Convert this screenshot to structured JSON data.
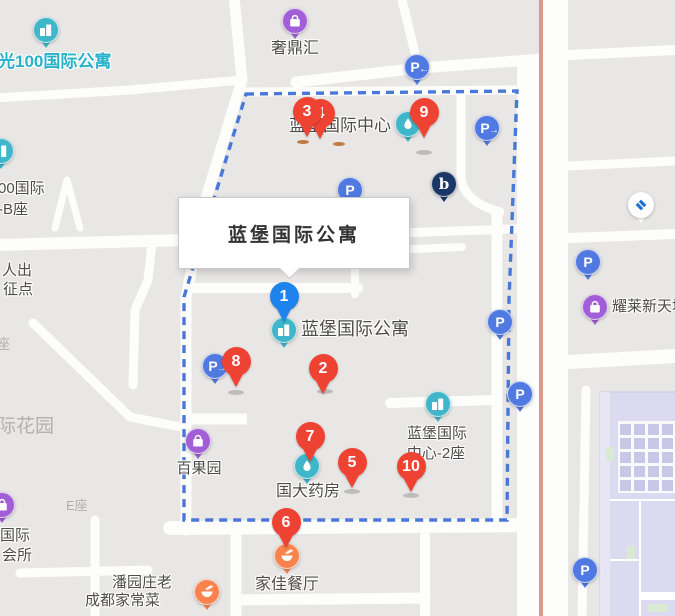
{
  "colors": {
    "map_background": "#e8e7e5",
    "road_white": "#fdfdfc",
    "boundary_dash_blue": "#4a78d9",
    "roadside_salmon": "#db998d",
    "pin_red": "#ee4333",
    "pin_blue": "#1f83ee",
    "poi_teal": "#3fb6c9",
    "poi_purple": "#a25ed6",
    "poi_orange": "#f9824d",
    "poi_parking_blue": "#5079e2",
    "poi_navy": "#1b3767",
    "bank_logo_blue": "#1c6fd0",
    "indoor_lavender": "#dbdaf0",
    "indoor_cell": "#c8c7e8",
    "indoor_green": "#d8ead2"
  },
  "map": {
    "infobox": {
      "text": "蓝堡国际公寓",
      "x": 178,
      "y": 197,
      "w": 230,
      "h": 70,
      "pointer_x": 288
    },
    "markers": [
      {
        "label": "4",
        "color": "red",
        "x": 320,
        "y": 114
      },
      {
        "label": "3",
        "color": "red",
        "x": 307,
        "y": 112
      },
      {
        "label": "9",
        "color": "red",
        "x": 424,
        "y": 113
      },
      {
        "label": "1",
        "color": "blue",
        "x": 284,
        "y": 297
      },
      {
        "label": "8",
        "color": "red",
        "x": 236,
        "y": 362
      },
      {
        "label": "2",
        "color": "red",
        "x": 323,
        "y": 369
      },
      {
        "label": "7",
        "color": "red",
        "x": 310,
        "y": 437
      },
      {
        "label": "5",
        "color": "red",
        "x": 352,
        "y": 463
      },
      {
        "label": "10",
        "color": "red",
        "x": 411,
        "y": 467
      },
      {
        "label": "6",
        "color": "red",
        "x": 286,
        "y": 523
      }
    ],
    "pois": [
      {
        "name": "apartment-building-icon",
        "glyph": "building",
        "color": "teal",
        "x": 46,
        "y": 30
      },
      {
        "name": "building-icon-left-edge",
        "glyph": "building",
        "color": "teal",
        "x": 1,
        "y": 151
      },
      {
        "name": "shopping-bag-icon",
        "glyph": "bag",
        "color": "purple",
        "x": 295,
        "y": 21
      },
      {
        "name": "parking-arrow-left-icon",
        "glyph": "P←",
        "color": "blue",
        "x": 417,
        "y": 67
      },
      {
        "name": "parking-arrow-right-icon",
        "glyph": "P→",
        "color": "blue",
        "x": 487,
        "y": 128
      },
      {
        "name": "droplet-icon",
        "glyph": "drop",
        "color": "teal",
        "x": 408,
        "y": 124
      },
      {
        "name": "brand-b-icon",
        "glyph": "b",
        "color": "navy",
        "x": 444,
        "y": 184
      },
      {
        "name": "parking-icon",
        "glyph": "P",
        "color": "blue",
        "x": 350,
        "y": 190
      },
      {
        "name": "bank-ccb-icon",
        "glyph": "ccb",
        "color": "white",
        "x": 641,
        "y": 205
      },
      {
        "name": "parking-icon",
        "glyph": "P",
        "color": "blue",
        "x": 588,
        "y": 262
      },
      {
        "name": "shopping-bag-icon",
        "glyph": "bag",
        "color": "purple",
        "x": 595,
        "y": 307
      },
      {
        "name": "apartment-building-icon",
        "glyph": "building",
        "color": "teal",
        "x": 284,
        "y": 330
      },
      {
        "name": "parking-arrow-right-icon",
        "glyph": "P→",
        "color": "blue",
        "x": 215,
        "y": 366
      },
      {
        "name": "parking-icon",
        "glyph": "P",
        "color": "blue",
        "x": 500,
        "y": 322
      },
      {
        "name": "parking-icon",
        "glyph": "P",
        "color": "blue",
        "x": 520,
        "y": 394
      },
      {
        "name": "office-building-icon",
        "glyph": "building",
        "color": "teal",
        "x": 438,
        "y": 404
      },
      {
        "name": "shopping-bag-icon",
        "glyph": "bag",
        "color": "purple",
        "x": 198,
        "y": 441
      },
      {
        "name": "pharmacy-droplet-icon",
        "glyph": "drop",
        "color": "teal",
        "x": 307,
        "y": 466
      },
      {
        "name": "shopping-bag-icon",
        "glyph": "bag",
        "color": "purple",
        "x": 2,
        "y": 505
      },
      {
        "name": "parking-icon",
        "glyph": "P",
        "color": "blue",
        "x": 585,
        "y": 570
      },
      {
        "name": "restaurant-bowl-icon",
        "glyph": "bowl",
        "color": "orange",
        "x": 287,
        "y": 556
      },
      {
        "name": "restaurant-bowl-icon",
        "glyph": "bowl",
        "color": "orange",
        "x": 207,
        "y": 592
      }
    ],
    "labels": [
      {
        "text": "光100国际公寓",
        "x": -2,
        "y": 63,
        "align": "left",
        "color": "teal",
        "size": 17,
        "inter": true
      },
      {
        "text": "奢鼎汇",
        "x": 295,
        "y": 50,
        "align": "center",
        "color": "dark",
        "size": 16,
        "inter": true
      },
      {
        "text": "蓝堡国际中心",
        "x": 340,
        "y": 127,
        "align": "center",
        "color": "dark",
        "size": 17,
        "inter": true
      },
      {
        "text": "00国际",
        "x": -2,
        "y": 189,
        "align": "left",
        "color": "dark",
        "size": 15,
        "inter": true
      },
      {
        "text": "-B座",
        "x": -2,
        "y": 210,
        "align": "left",
        "color": "dark",
        "size": 15,
        "inter": true
      },
      {
        "text": "人出",
        "x": 2,
        "y": 271,
        "align": "left",
        "color": "dark",
        "size": 15,
        "inter": true
      },
      {
        "text": "征点",
        "x": 3,
        "y": 290,
        "align": "left",
        "color": "dark",
        "size": 15,
        "inter": true
      },
      {
        "text": "座",
        "x": -4,
        "y": 345,
        "align": "left",
        "color": "muted",
        "size": 14,
        "inter": false
      },
      {
        "text": "际花园",
        "x": -3,
        "y": 428,
        "align": "left",
        "color": "muted",
        "size": 19,
        "inter": false
      },
      {
        "text": "蓝堡国际公寓",
        "x": 301,
        "y": 330,
        "align": "left",
        "color": "dark",
        "size": 18,
        "inter": true
      },
      {
        "text": "百果园",
        "x": 199,
        "y": 469,
        "align": "center",
        "color": "dark",
        "size": 15,
        "inter": true
      },
      {
        "text": "国大药房",
        "x": 308,
        "y": 493,
        "align": "center",
        "color": "dark",
        "size": 16,
        "inter": true
      },
      {
        "text": "蓝堡国际",
        "x": 437,
        "y": 434,
        "align": "center",
        "color": "dark",
        "size": 15,
        "inter": true
      },
      {
        "text": "中心-2座",
        "x": 436,
        "y": 454,
        "align": "center",
        "color": "dark",
        "size": 15,
        "inter": true
      },
      {
        "text": "耀莱新天地",
        "x": 612,
        "y": 307,
        "align": "left",
        "color": "dark",
        "size": 15,
        "inter": true
      },
      {
        "text": "E座",
        "x": 66,
        "y": 507,
        "align": "left",
        "color": "muted",
        "size": 13,
        "inter": false
      },
      {
        "text": "国际",
        "x": 0,
        "y": 536,
        "align": "left",
        "color": "dark",
        "size": 15,
        "inter": true
      },
      {
        "text": "会所",
        "x": 2,
        "y": 556,
        "align": "left",
        "color": "dark",
        "size": 15,
        "inter": true
      },
      {
        "text": "潘园庄老",
        "x": 112,
        "y": 583,
        "align": "left",
        "color": "dark",
        "size": 15,
        "inter": true
      },
      {
        "text": "成都家常菜",
        "x": 85,
        "y": 601,
        "align": "left",
        "color": "dark",
        "size": 15,
        "inter": true
      },
      {
        "text": "家佳餐厅",
        "x": 287,
        "y": 586,
        "align": "center",
        "color": "dark",
        "size": 16,
        "inter": true
      }
    ],
    "shadows": [
      {
        "x": 236,
        "y": 392,
        "w": 16,
        "h": 5,
        "kind": "gray"
      },
      {
        "x": 325,
        "y": 391,
        "w": 16,
        "h": 5,
        "kind": "gray"
      },
      {
        "x": 352,
        "y": 491,
        "w": 16,
        "h": 5,
        "kind": "gray"
      },
      {
        "x": 411,
        "y": 495,
        "w": 16,
        "h": 5,
        "kind": "gray"
      },
      {
        "x": 424,
        "y": 152,
        "w": 16,
        "h": 5,
        "kind": "gray"
      },
      {
        "x": 303,
        "y": 142,
        "w": 12,
        "h": 4,
        "kind": "orange"
      },
      {
        "x": 339,
        "y": 144,
        "w": 12,
        "h": 4,
        "kind": "orange"
      }
    ]
  }
}
